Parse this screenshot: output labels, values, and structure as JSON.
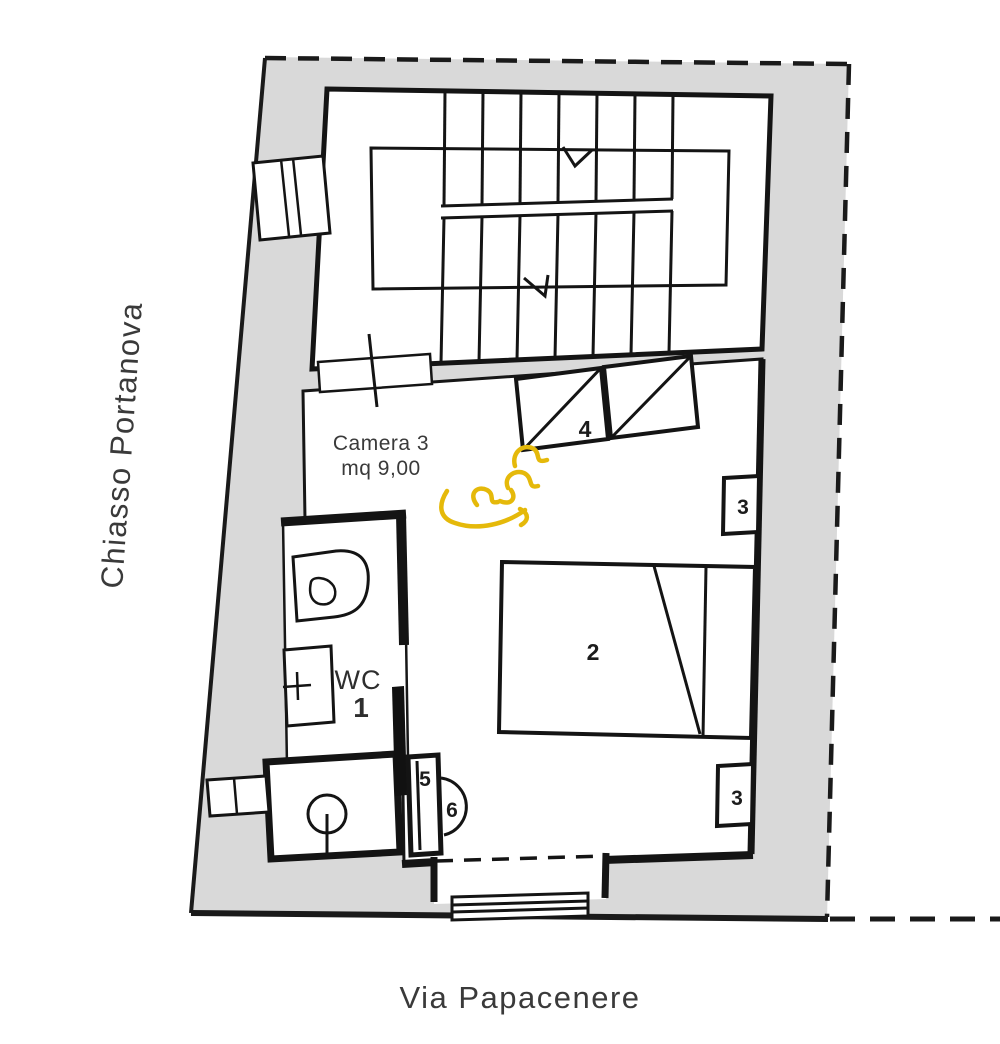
{
  "plan": {
    "type": "apartment-floor-plan",
    "room": {
      "name": "Camera 3",
      "area": "mq 9,00"
    },
    "wc_label": "WC",
    "markers": {
      "m1": "1",
      "m2": "2",
      "m3a": "3",
      "m3b": "3",
      "m4": "4",
      "m5": "5",
      "m6": "6"
    },
    "streets": {
      "left": "Chiasso Portanova",
      "bottom": "Via Papacenere"
    },
    "symbols": [
      "staircase",
      "stair-direction-arrow",
      "toilet",
      "washbasin",
      "shower-drain",
      "double-bed",
      "wardrobe",
      "nightstand",
      "door-leaf",
      "door-swing",
      "entrance-steps",
      "window",
      "signature-scribble"
    ],
    "colors": {
      "wall_fill": "#d9d9d9",
      "line": "#1a1a1a",
      "signature": "#e5b90a",
      "text": "#3a3a3a"
    }
  }
}
